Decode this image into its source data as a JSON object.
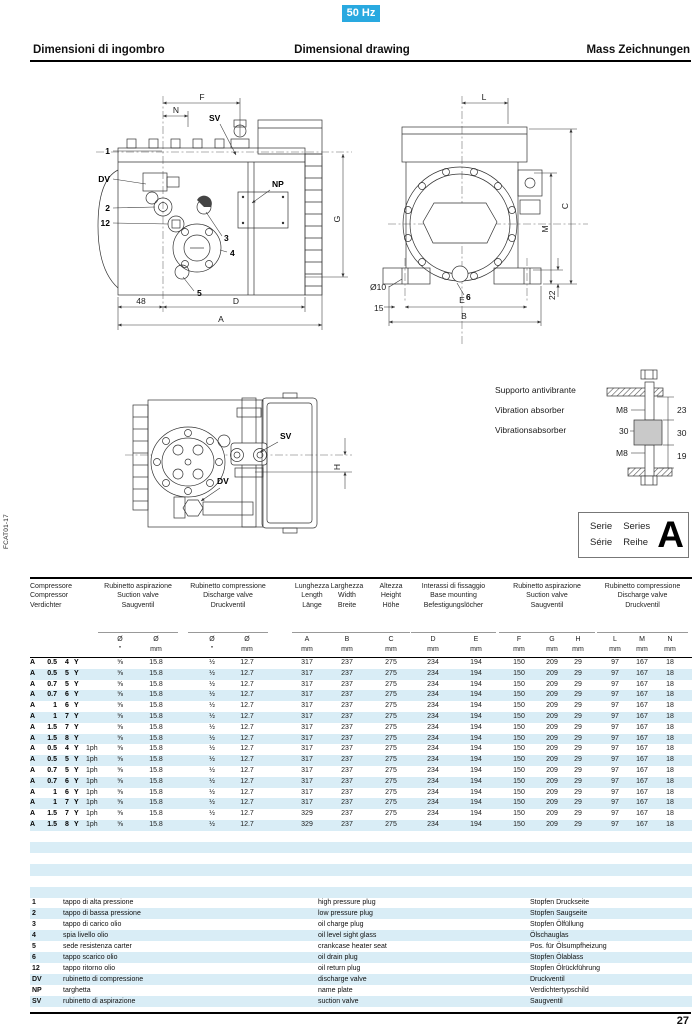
{
  "page": {
    "badge": "50 Hz",
    "page_number": "27",
    "side_code": "FCAT01-17"
  },
  "header": {
    "title_it": "Dimensioni di ingombro",
    "title_en": "Dimensional drawing",
    "title_de": "Mass Zeichnungen"
  },
  "drawings": {
    "front": {
      "f": "F",
      "n": "N",
      "sv": "SV",
      "p1": "1",
      "dv": "DV",
      "p2": "2",
      "p12": "12",
      "np": "NP",
      "p3": "3",
      "p4": "4",
      "p5": "5",
      "d48": "48",
      "d": "D",
      "a": "A",
      "g": "G"
    },
    "end": {
      "l": "L",
      "c": "C",
      "m": "M",
      "d22": "22",
      "dia10": "Ø10",
      "d15": "15",
      "p6": "6",
      "e": "E",
      "b": "B"
    },
    "top": {
      "sv": "SV",
      "dv": "DV",
      "h": "H"
    },
    "absorber": {
      "caption_it": "Supporto antivibrante",
      "caption_en": "Vibration absorber",
      "caption_de": "Vibrationsabsorber",
      "m8a": "M8",
      "d30l": "30",
      "m8b": "M8",
      "d23": "23",
      "d30r": "30",
      "d19": "19"
    }
  },
  "series_box": {
    "c1l1": "Serie",
    "c1l2": "Série",
    "c2l1": "Series",
    "c2l2": "Reihe",
    "letter": "A"
  },
  "table": {
    "groups": [
      {
        "lines": [
          "Compressore",
          "Compressor",
          "Verdichter"
        ]
      },
      {
        "lines": [
          "Rubinetto aspirazione",
          "Suction valve",
          "Saugventil"
        ]
      },
      {
        "lines": [
          "Rubinetto compressione",
          "Discharge valve",
          "Druckventil"
        ]
      },
      {
        "lines": [
          "Lunghezza",
          "Length",
          "Länge"
        ]
      },
      {
        "lines": [
          "Larghezza",
          "Width",
          "Breite"
        ]
      },
      {
        "lines": [
          "Altezza",
          "Height",
          "Höhe"
        ]
      },
      {
        "lines": [
          "Interassi di fissaggio",
          "Base mounting",
          "Befestigungslöcher"
        ]
      },
      {
        "lines": [
          "Rubinetto aspirazione",
          "Suction valve",
          "Saugventil"
        ]
      },
      {
        "lines": [
          "Rubinetto compressione",
          "Discharge valve",
          "Druckventil"
        ]
      }
    ],
    "subheaders": [
      [
        "Ø",
        "\""
      ],
      [
        "Ø",
        "mm"
      ],
      [
        "Ø",
        "\""
      ],
      [
        "Ø",
        "mm"
      ],
      [
        "A",
        "mm"
      ],
      [
        "B",
        "mm"
      ],
      [
        "C",
        "mm"
      ],
      [
        "D",
        "mm"
      ],
      [
        "E",
        "mm"
      ],
      [
        "F",
        "mm"
      ],
      [
        "G",
        "mm"
      ],
      [
        "H",
        "mm"
      ],
      [
        "L",
        "mm"
      ],
      [
        "M",
        "mm"
      ],
      [
        "N",
        "mm"
      ]
    ],
    "rows": [
      [
        "A",
        "0.5",
        "4",
        "Y",
        "",
        "⅝",
        "15.8",
        "½",
        "12.7",
        "317",
        "237",
        "275",
        "234",
        "194",
        "150",
        "209",
        "29",
        "97",
        "167",
        "18"
      ],
      [
        "A",
        "0.5",
        "5",
        "Y",
        "",
        "⅝",
        "15.8",
        "½",
        "12.7",
        "317",
        "237",
        "275",
        "234",
        "194",
        "150",
        "209",
        "29",
        "97",
        "167",
        "18"
      ],
      [
        "A",
        "0.7",
        "5",
        "Y",
        "",
        "⅝",
        "15.8",
        "½",
        "12.7",
        "317",
        "237",
        "275",
        "234",
        "194",
        "150",
        "209",
        "29",
        "97",
        "167",
        "18"
      ],
      [
        "A",
        "0.7",
        "6",
        "Y",
        "",
        "⅝",
        "15.8",
        "½",
        "12.7",
        "317",
        "237",
        "275",
        "234",
        "194",
        "150",
        "209",
        "29",
        "97",
        "167",
        "18"
      ],
      [
        "A",
        "1",
        "6",
        "Y",
        "",
        "⅝",
        "15.8",
        "½",
        "12.7",
        "317",
        "237",
        "275",
        "234",
        "194",
        "150",
        "209",
        "29",
        "97",
        "167",
        "18"
      ],
      [
        "A",
        "1",
        "7",
        "Y",
        "",
        "⅝",
        "15.8",
        "½",
        "12.7",
        "317",
        "237",
        "275",
        "234",
        "194",
        "150",
        "209",
        "29",
        "97",
        "167",
        "18"
      ],
      [
        "A",
        "1.5",
        "7",
        "Y",
        "",
        "⅝",
        "15.8",
        "½",
        "12.7",
        "317",
        "237",
        "275",
        "234",
        "194",
        "150",
        "209",
        "29",
        "97",
        "167",
        "18"
      ],
      [
        "A",
        "1.5",
        "8",
        "Y",
        "",
        "⅝",
        "15.8",
        "½",
        "12.7",
        "317",
        "237",
        "275",
        "234",
        "194",
        "150",
        "209",
        "29",
        "97",
        "167",
        "18"
      ],
      [
        "A",
        "0.5",
        "4",
        "Y",
        "1ph",
        "⅝",
        "15.8",
        "½",
        "12.7",
        "317",
        "237",
        "275",
        "234",
        "194",
        "150",
        "209",
        "29",
        "97",
        "167",
        "18"
      ],
      [
        "A",
        "0.5",
        "5",
        "Y",
        "1ph",
        "⅝",
        "15.8",
        "½",
        "12.7",
        "317",
        "237",
        "275",
        "234",
        "194",
        "150",
        "209",
        "29",
        "97",
        "167",
        "18"
      ],
      [
        "A",
        "0.7",
        "5",
        "Y",
        "1ph",
        "⅝",
        "15.8",
        "½",
        "12.7",
        "317",
        "237",
        "275",
        "234",
        "194",
        "150",
        "209",
        "29",
        "97",
        "167",
        "18"
      ],
      [
        "A",
        "0.7",
        "6",
        "Y",
        "1ph",
        "⅝",
        "15.8",
        "½",
        "12.7",
        "317",
        "237",
        "275",
        "234",
        "194",
        "150",
        "209",
        "29",
        "97",
        "167",
        "18"
      ],
      [
        "A",
        "1",
        "6",
        "Y",
        "1ph",
        "⅝",
        "15.8",
        "½",
        "12.7",
        "317",
        "237",
        "275",
        "234",
        "194",
        "150",
        "209",
        "29",
        "97",
        "167",
        "18"
      ],
      [
        "A",
        "1",
        "7",
        "Y",
        "1ph",
        "⅝",
        "15.8",
        "½",
        "12.7",
        "317",
        "237",
        "275",
        "234",
        "194",
        "150",
        "209",
        "29",
        "97",
        "167",
        "18"
      ],
      [
        "A",
        "1.5",
        "7",
        "Y",
        "1ph",
        "⅝",
        "15.8",
        "½",
        "12.7",
        "329",
        "237",
        "275",
        "234",
        "194",
        "150",
        "209",
        "29",
        "97",
        "167",
        "18"
      ],
      [
        "A",
        "1.5",
        "8",
        "Y",
        "1ph",
        "⅝",
        "15.8",
        "½",
        "12.7",
        "329",
        "237",
        "275",
        "234",
        "194",
        "150",
        "209",
        "29",
        "97",
        "167",
        "18"
      ]
    ]
  },
  "legend": {
    "items": [
      {
        "key": "1",
        "it": "tappo di alta pressione",
        "en": "high pressure plug",
        "de": "Stopfen Druckseite"
      },
      {
        "key": "2",
        "it": "tappo di bassa pressione",
        "en": "low pressure plug",
        "de": "Stopfen Saugseite"
      },
      {
        "key": "3",
        "it": "tappo di carico olio",
        "en": "oil charge plug",
        "de": "Stopfen Ölfüllung"
      },
      {
        "key": "4",
        "it": "spia livello olio",
        "en": "oil level sight glass",
        "de": "Ölschauglas"
      },
      {
        "key": "5",
        "it": "sede resistenza carter",
        "en": "crankcase heater seat",
        "de": "Pos. für Ölsumpfheizung"
      },
      {
        "key": "6",
        "it": "tappo scarico olio",
        "en": "oil drain plug",
        "de": "Stopfen Ölablass"
      },
      {
        "key": "12",
        "it": "tappo ritorno olio",
        "en": "oil return plug",
        "de": "Stopfen Ölrückführung"
      },
      {
        "key": "DV",
        "it": "rubinetto di compressione",
        "en": "discharge valve",
        "de": "Druckventil"
      },
      {
        "key": "NP",
        "it": "targhetta",
        "en": "name plate",
        "de": "Verdichtertypschild"
      },
      {
        "key": "SV",
        "it": "rubinetto di aspirazione",
        "en": "suction valve",
        "de": "Saugventil"
      }
    ]
  }
}
